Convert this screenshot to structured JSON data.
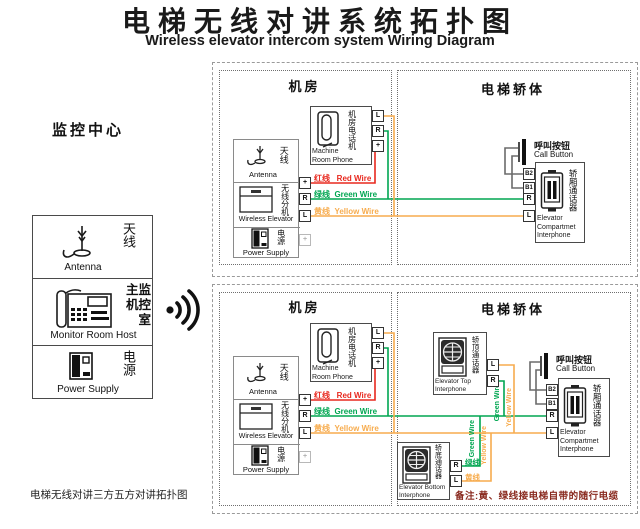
{
  "title": {
    "zh": "电梯无线对讲系统拓扑图",
    "en": "Wireless elevator intercom system Wiring Diagram"
  },
  "monitoring_center": {
    "label": "监控中心",
    "legend": [
      {
        "zh": "天线",
        "en": "Antenna"
      },
      {
        "zh_lines": [
          "主监",
          "机控",
          "室"
        ],
        "en": "Monitor Room Host"
      },
      {
        "zh": "电源",
        "en": "Power Supply"
      }
    ]
  },
  "machine_room_top": {
    "title": "机房",
    "antenna": {
      "zh": "天线",
      "en": "Antenna"
    },
    "wireless_extension": {
      "zh": "无线分机",
      "en": "Wireless Elevator"
    },
    "power": {
      "zh": "电源",
      "en": "Power Supply"
    },
    "combo_terminals": [
      "+",
      "R",
      "L",
      "+"
    ],
    "phone": {
      "zh": "机房电话机",
      "en_lines": [
        "Machine",
        "Room Phone"
      ],
      "terminals": [
        "L",
        "R",
        "+"
      ]
    },
    "wire_labels": {
      "red": "红线   Red Wire",
      "green": "绿线  Green Wire",
      "yellow": "黄线  Yellow Wire"
    }
  },
  "elevator_body_top": {
    "title": "电梯轿体",
    "call_button": {
      "zh": "呼叫按钮",
      "en": "Call Button"
    },
    "compartment": {
      "zh": "轿厢通话器",
      "en_lines": [
        "Elevator",
        "Compartmet",
        "Interphone"
      ],
      "terminals": [
        "B2",
        "B1",
        "R",
        "L"
      ]
    }
  },
  "machine_room_bottom": {
    "title": "机房",
    "antenna": {
      "zh": "天线",
      "en": "Antenna"
    },
    "wireless_extension": {
      "zh": "无线分机",
      "en": "Wireless Elevator"
    },
    "power": {
      "zh": "电源",
      "en": "Power Supply"
    },
    "combo_terminals": [
      "+",
      "R",
      "L",
      "+"
    ],
    "phone": {
      "zh": "机房电话机",
      "en_lines": [
        "Machine",
        "Room Phone"
      ],
      "terminals": [
        "L",
        "R",
        "+"
      ]
    },
    "wire_labels": {
      "red": "红线   Red Wire",
      "green": "绿线  Green Wire",
      "yellow": "黄线  Yellow Wire"
    }
  },
  "elevator_body_bottom": {
    "title": "电梯轿体",
    "call_button": {
      "zh": "呼叫按钮",
      "en": "Call Button"
    },
    "compartment": {
      "zh": "轿厢通话器",
      "en_lines": [
        "Elevator",
        "Compartmet",
        "Interphone"
      ],
      "terminals": [
        "B2",
        "B1",
        "R",
        "L"
      ]
    },
    "top_interphone": {
      "zh": "轿顶通话器",
      "en_lines": [
        "Elevator Top",
        "Interphone"
      ],
      "terminals": [
        "L",
        "R"
      ]
    },
    "bottom_interphone": {
      "zh": "轿底通话器",
      "en_lines": [
        "Elevator Bottom",
        "Interphone"
      ],
      "terminals": [
        "R",
        "L"
      ],
      "wire_labels": {
        "green": "绿线",
        "yellow": "黄线"
      }
    },
    "riser_labels": {
      "green": "Green Wire",
      "yellow": "Yellow Wire"
    },
    "note": "备注:黄、绿线接电梯自带的随行电缆"
  },
  "footer": "电梯无线对讲三方五方对讲拓扑图",
  "colors": {
    "red_wire": "#e8281e",
    "green_wire": "#00a651",
    "yellow_wire": "#f7ac4e",
    "note": "#8a2b20"
  }
}
